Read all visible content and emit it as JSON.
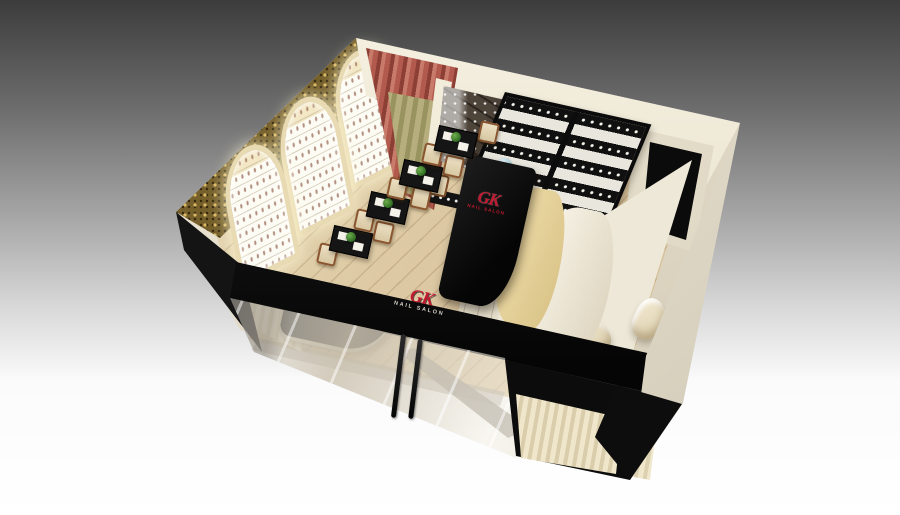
{
  "meta": {
    "image_type": "3D interior render",
    "subject": "GK Nail Salon — isometric cutaway view of shop interior",
    "view": "top-front isometric, gray-to-white studio backdrop"
  },
  "branding": {
    "partition_logo": {
      "initials": "GK",
      "caption": "NAIL SALON",
      "color": "#c2182f"
    },
    "storefront_logo": {
      "initials": "GK",
      "caption": "NAIL SALON",
      "initials_color": "#c2182f",
      "caption_color": "#d6d2c9"
    }
  },
  "palette": {
    "backdrop_top": "#3c3c3c",
    "backdrop_bottom": "#ffffff",
    "wall_cream": "#ece5d3",
    "storefront_black": "#0c0c0c",
    "wallpaper_gold": "#8a7238",
    "curtain_red": "#a54c40",
    "sheer_olive": "#a9a26e",
    "wood_floor": "#dcc9a4",
    "logo_red": "#c2182f",
    "cushion_cream": "#e8dcc0",
    "chair_wood": "#8a5630",
    "plant_green": "#3f7a2e"
  },
  "scene": {
    "elements": [
      {
        "name": "room-shell",
        "label": "Cream wall-top rim of open-roof room box"
      },
      {
        "name": "left-wall-wallpaper",
        "label": "Gold damask wallpaper wall"
      },
      {
        "name": "display-arches",
        "label": "3 arched backlit nail-polish shelf bays",
        "count": 3
      },
      {
        "name": "red-curtain",
        "label": "Red drapes with olive sheer on back wall"
      },
      {
        "name": "floral-wallpaper-panel",
        "label": "Dark floral branch wallpaper in VIP nook"
      },
      {
        "name": "polish-wall-rack",
        "label": "Black wall rack, striped rows of polish bottles"
      },
      {
        "name": "tv-panel",
        "label": "Black panel on right rear cabinet"
      },
      {
        "name": "gk-partition",
        "label": "Black S-curve partition with red GK logo"
      },
      {
        "name": "service-counters",
        "label": "White counters and drawer cabinet"
      },
      {
        "name": "manicure-stations",
        "label": "Manicure tables with white mats, wood chairs, plants",
        "count": 4
      },
      {
        "name": "pedicure-area",
        "label": "White-floor pedicure zone with 2 cream massage chairs and curtain"
      },
      {
        "name": "reception-desk",
        "label": "Curved black reception desk behind storefront glass"
      },
      {
        "name": "storefront",
        "label": "Black fascia with GK logo, glass front, two black door handles"
      },
      {
        "name": "right-wall",
        "label": "Cream exterior right wall with black corner band"
      },
      {
        "name": "floor",
        "label": "Light wood plank floor with gray runner"
      }
    ]
  }
}
